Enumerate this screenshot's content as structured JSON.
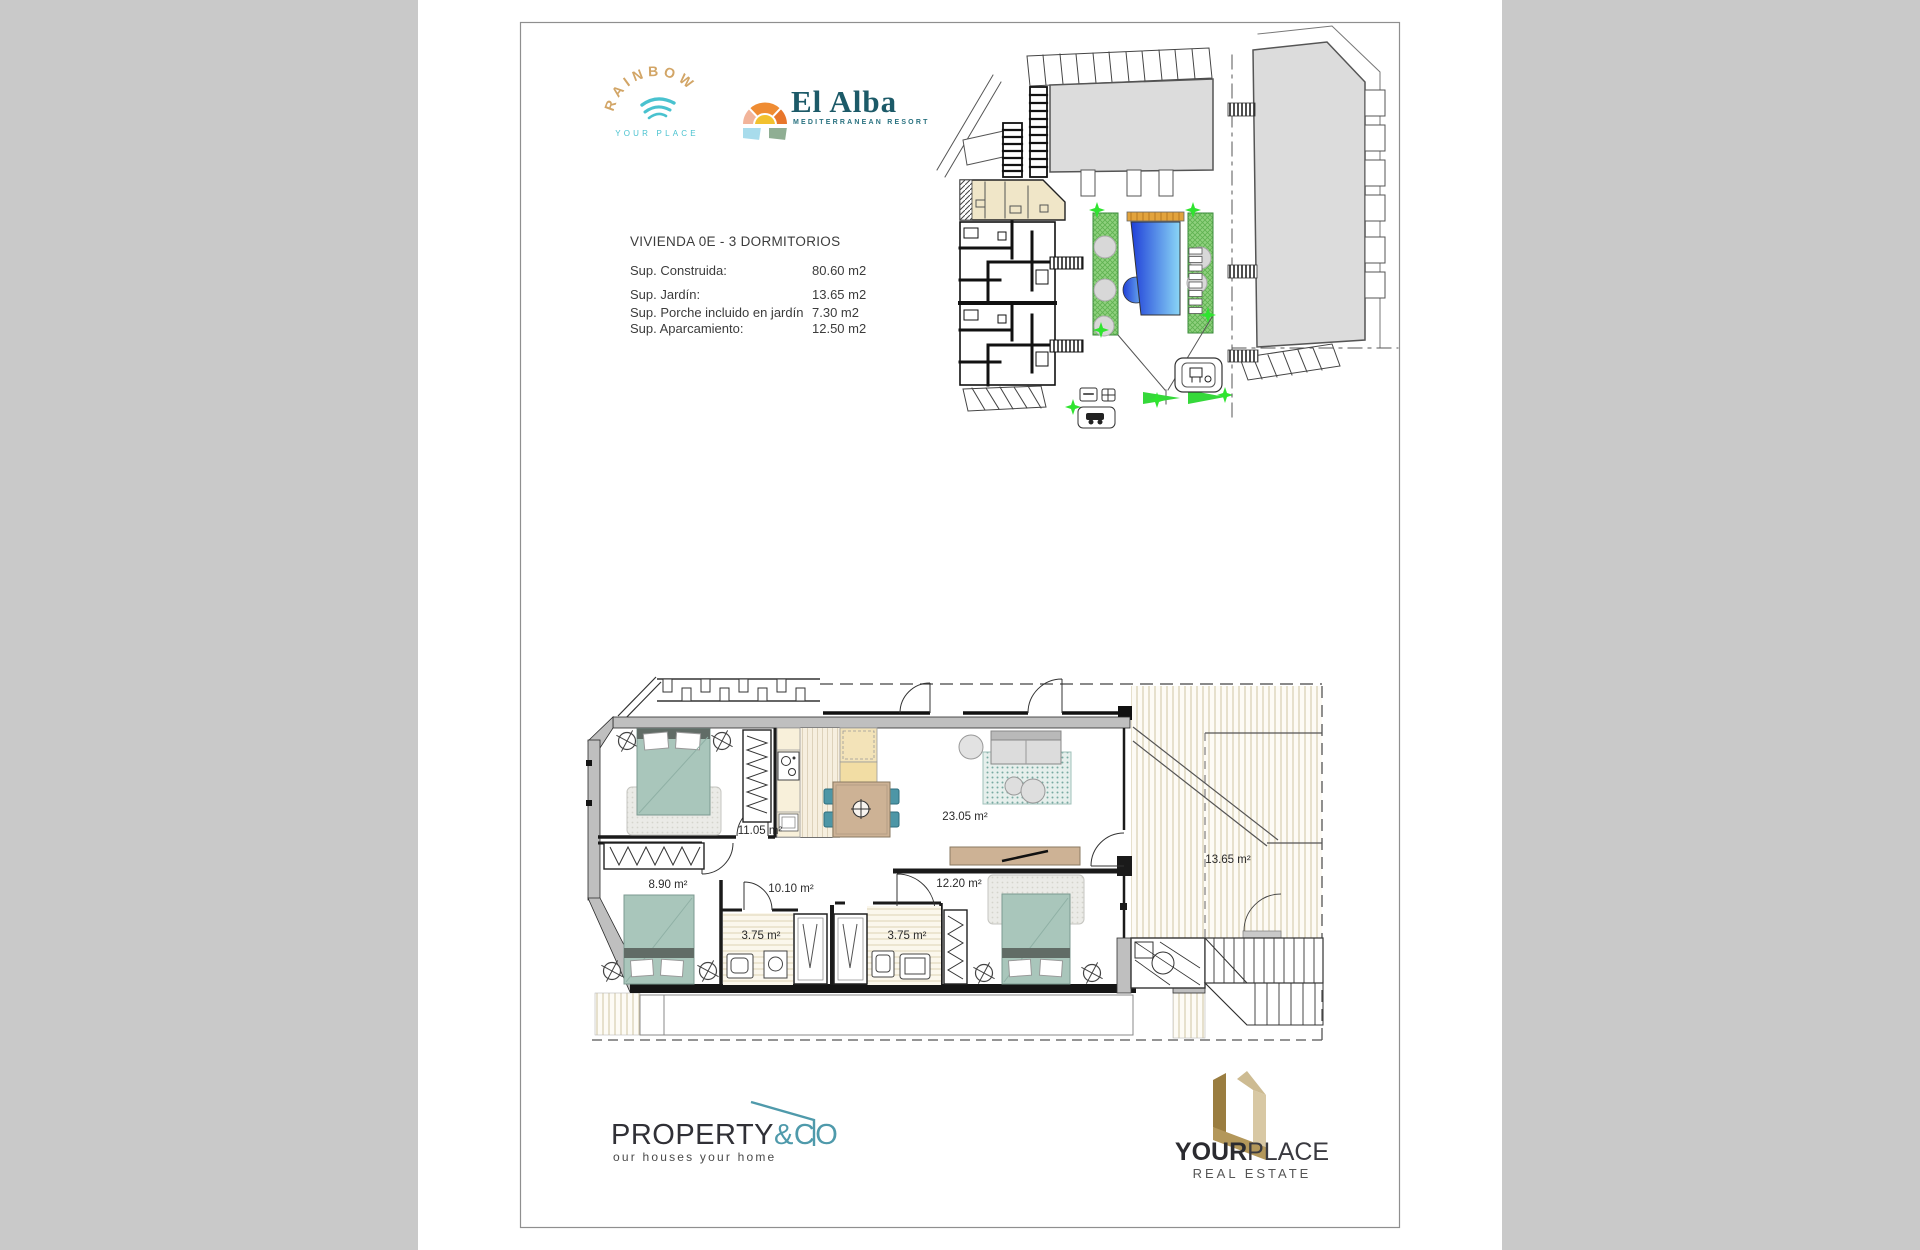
{
  "page": {
    "background": "#c9c9c9",
    "paper": "#ffffff",
    "frame_color": "#8f8f8f",
    "accents": {
      "teal": "#4f9aab",
      "logo_gold": "#d2a566",
      "pool_blue": "#2a55d8",
      "garden_green": "#6fbf5e",
      "bed_teal": "#a9c6bb",
      "wood_tan": "#cdb295"
    }
  },
  "header": {
    "rainbow": {
      "name": "RAINBOW",
      "tagline": "YOUR PLACE"
    },
    "el_alba": {
      "name": "El Alba",
      "tagline": "MEDITERRANEAN RESORT"
    }
  },
  "specs": {
    "title": "VIVIENDA  0E - 3 DORMITORIOS",
    "rows": [
      {
        "label": "Sup. Construida:",
        "value": "80.60 m2"
      },
      {
        "label": "Sup. Jardín:",
        "value": "13.65 m2"
      },
      {
        "label": "Sup. Porche incluido en jardín",
        "value": "7.30 m2"
      },
      {
        "label": "Sup. Aparcamiento:",
        "value": "12.50 m2"
      }
    ]
  },
  "floor_plan": {
    "rooms": [
      {
        "name": "bedroom-1",
        "area": "11.05 m²"
      },
      {
        "name": "bedroom-2",
        "area": "8.90 m²"
      },
      {
        "name": "hallway",
        "area": "10.10 m²"
      },
      {
        "name": "bathroom-1",
        "area": "3.75 m²"
      },
      {
        "name": "bathroom-2",
        "area": "3.75 m²"
      },
      {
        "name": "bedroom-3",
        "area": "12.20 m²"
      },
      {
        "name": "living-kitchen",
        "area": "23.05 m²"
      },
      {
        "name": "garden",
        "area": "13.65 m²"
      }
    ]
  },
  "footer": {
    "property_co": {
      "name_dark": "PROPERTY",
      "name_teal": "&CO",
      "tagline": "our houses your home"
    },
    "your_place": {
      "name_bold": "YOUR",
      "name_light": "PLACE",
      "tagline": "REAL ESTATE"
    }
  }
}
